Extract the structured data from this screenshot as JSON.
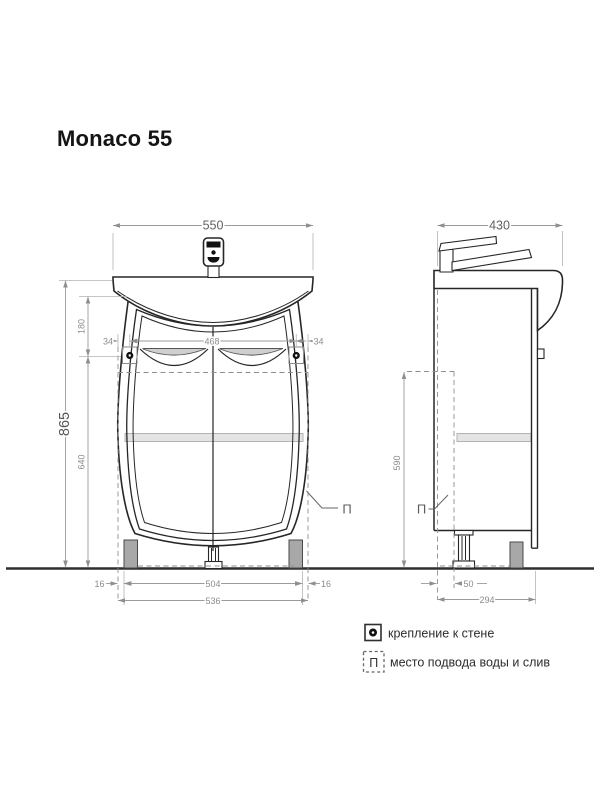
{
  "title": "Monaco 55",
  "front_view": {
    "dim_width_top": "550",
    "dim_height_total": "865",
    "dim_top_to_mount": "180",
    "dim_mount_to_floor": "640",
    "dim_offset_left": "34",
    "dim_mount_span": "468",
    "dim_offset_right": "34",
    "dim_foot_inset_left": "16",
    "dim_feet_span": "504",
    "dim_foot_inset_right": "16",
    "dim_width_bottom": "536",
    "pipe_label": "П"
  },
  "side_view": {
    "dim_depth_top": "430",
    "dim_supply_height": "590",
    "dim_supply_offset": "50",
    "dim_depth_bottom": "294",
    "pipe_label": "П"
  },
  "legend": {
    "wall_mount_label": "крепление к стене",
    "supply_symbol": "П",
    "supply_label": "место подвода воды и слив"
  }
}
